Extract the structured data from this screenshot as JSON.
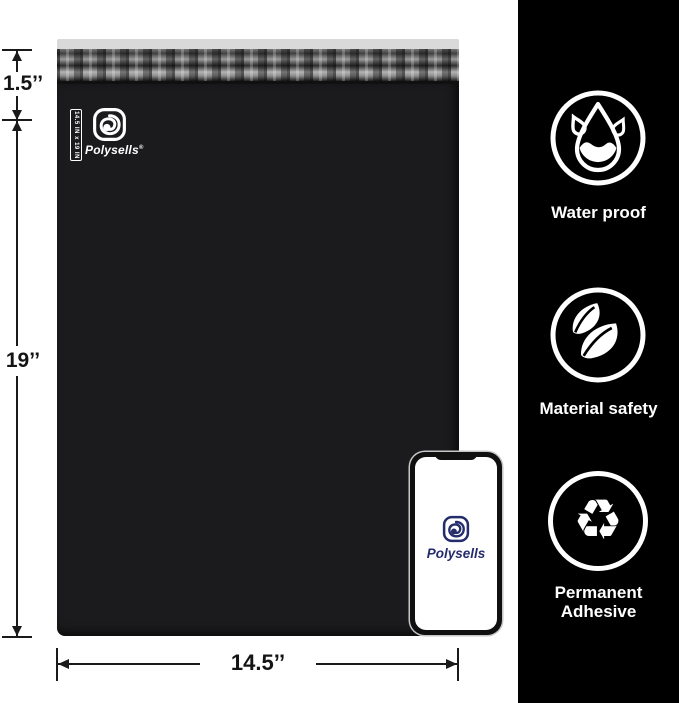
{
  "product": {
    "brand": "Polysells",
    "registered_mark": "®",
    "size_tag": "14.5 IN x 19 IN"
  },
  "dimensions": {
    "flap_height": "1.5’’",
    "bag_height": "19’’",
    "bag_width": "14.5’’"
  },
  "phone": {
    "brand": "Polysells"
  },
  "features": [
    {
      "icon": "water-drop-icon",
      "label": "Water proof"
    },
    {
      "icon": "leaves-icon",
      "label": "Material safety"
    },
    {
      "icon": "recycle-icon",
      "label": "Permanent Adhesive",
      "glyph": "♻"
    }
  ],
  "colors": {
    "sidebar_bg": "#000000",
    "bag_body": "#1b1b1d",
    "flap_edge": "#d9d9d9",
    "annotation": "#1a1a1a",
    "brand_navy": "#252c6b",
    "icon_white": "#ffffff"
  }
}
